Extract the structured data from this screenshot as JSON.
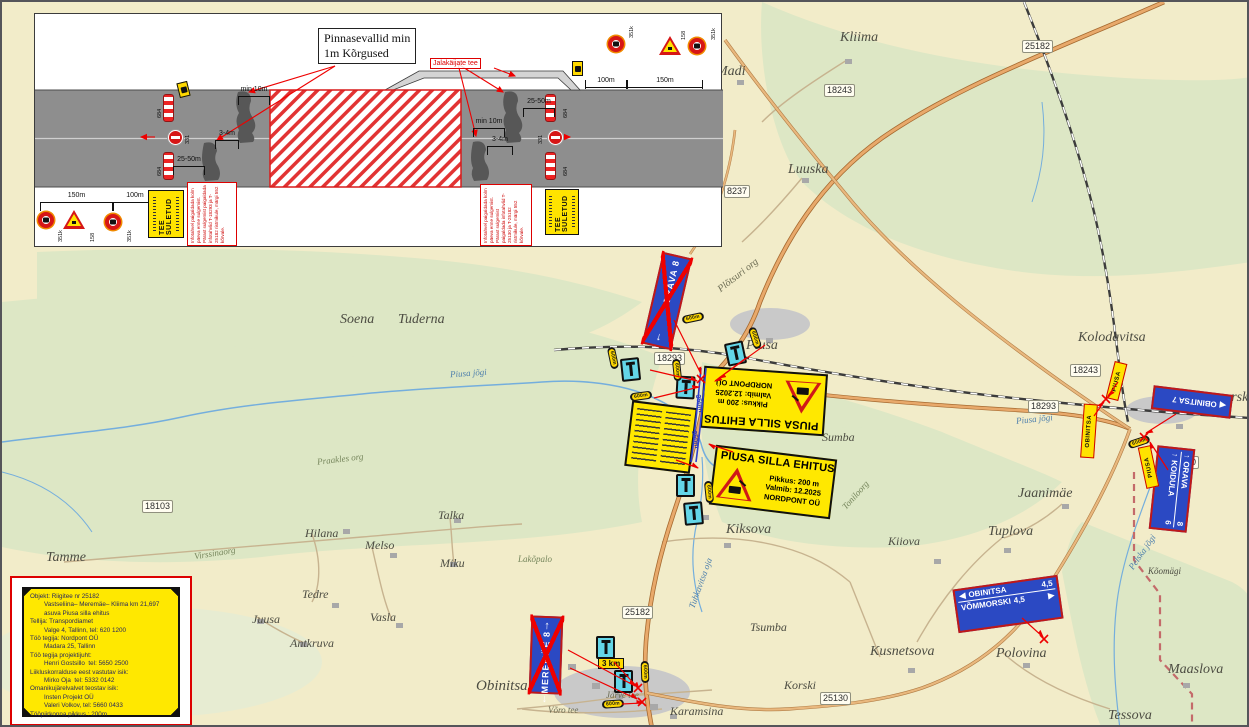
{
  "icons": {
    "up_arrow": "↑",
    "down_arrow": "↓",
    "left_arrow": "◀",
    "right_arrow": "▶"
  },
  "colors": {
    "sign_yellow": "#ffe800",
    "sign_blue": "#2b49c3",
    "sign_red": "#dd0000",
    "detour_cyan": "#63d6e8",
    "map_forest": "#dde7c5",
    "map_field": "#f2ecc9"
  },
  "inset": {
    "berm_note_line1": "Pinnasevallid min",
    "berm_note_line2": "1m Kõrgused",
    "ped_path_label": "Jalakäijate tee",
    "closed_plate_title": "TEE SULETUD",
    "note_left": "Infotahvel paigaldada kolm päeva enne sulgemist. Pärast sulgemist paigaldada infotahvlid T-18293 ja T-25182 ristmikule, märgi 552 kõrvale.",
    "note_right": "Infotahvel paigaldada kolm päeva enne sulgemist. Pärast sulgemist paigaldada infotahvlid T-25130 ja T-25182 ristmikule, märgi 552 kõrvale.",
    "dim_150": "150m",
    "dim_100": "100m",
    "dim_2550": "25-50m",
    "dim_min10": "min 10m",
    "dim_34": "3-4m",
    "code_684": "684",
    "code_331": "331",
    "code_158": "158",
    "code_351k": "351k"
  },
  "info_box": {
    "lines": [
      "Objekt: Riigitee nr 25182",
      "        Vastseliina– Meremäe– Kliima km 21,697",
      "        asuva Piusa silla ehitus",
      "Tellija: Transpordiamet",
      "        Valge 4, Tallinn, tel: 620 1200",
      "Töö tegija: Nordpont OÜ",
      "        Madara 25, Tallinn",
      "Töö tegija projektijuht:",
      "        Henri Gostsillo  tel: 5650 2500",
      "Liikluskorralduse eest vastutav isik:",
      "        Mirko Oja  tel: 5332 0142",
      "Omanikujärelvalvet teostav isik:",
      "        Insten Projekt OÜ",
      "        Valeri Volkov, tel: 5660 0433",
      "Tööpiirkonna pikkus : 200m"
    ]
  },
  "map": {
    "places": [
      "Kliima",
      "Madi",
      "Luuska",
      "Kolodavitsa",
      "Soena",
      "Tuderna",
      "Piusa",
      "Plõtsuri org",
      "Piusa jõgi",
      "Piusa jõgi",
      "Praakles org",
      "Tamme",
      "Virssinaorg",
      "Hilana",
      "Melso",
      "Talka",
      "Miku",
      "Tedre",
      "Juusa",
      "Antkruva",
      "Vasla",
      "Lakõpalo",
      "Kiksova",
      "Sumba",
      "Tuhkavitsa oja",
      "Kiiova",
      "Tuplova",
      "Jaanimäe",
      "Toniloorg",
      "Tsumba",
      "Kusnetsova",
      "Korski",
      "Polovina",
      "Maaslova",
      "Tessova",
      "Karamsina",
      "Obinitsa",
      "Võro tee",
      "Järve tee",
      "Vommorski",
      "Pelska jõgi",
      "Kõomägi"
    ],
    "badges": [
      "25182",
      "18243",
      "8237",
      "18103",
      "18293",
      "18293",
      "18243",
      "25130",
      "25182",
      "25130"
    ]
  },
  "signs": {
    "bridge_sign": {
      "title": "PIUSA SILLA EHITUS",
      "line1": "Pikkus: 200 m",
      "line2": "Valmib: 12.2025",
      "line3": "NORDPONT OÜ"
    },
    "orava_down": "ORAVA 8",
    "meremae": "MEREMÄE 8",
    "obinitsa7": "OBINITSA 7",
    "obin_vomm": {
      "row1": "OBINITSA",
      "row1_dist": "4,5",
      "row2": "VÕMMORSKI",
      "row2_dist": "4,5"
    },
    "orava_koidula": {
      "row1": "ORAVA",
      "row1_dist": "8",
      "row2": "KOIDULA",
      "row2_dist": "6"
    },
    "detour_piusa": "PIUSA",
    "detour_obinitsa": "OBINITSA",
    "plate_600m": "600m",
    "plate_3km": "3 km",
    "plate_350m": "350m"
  }
}
